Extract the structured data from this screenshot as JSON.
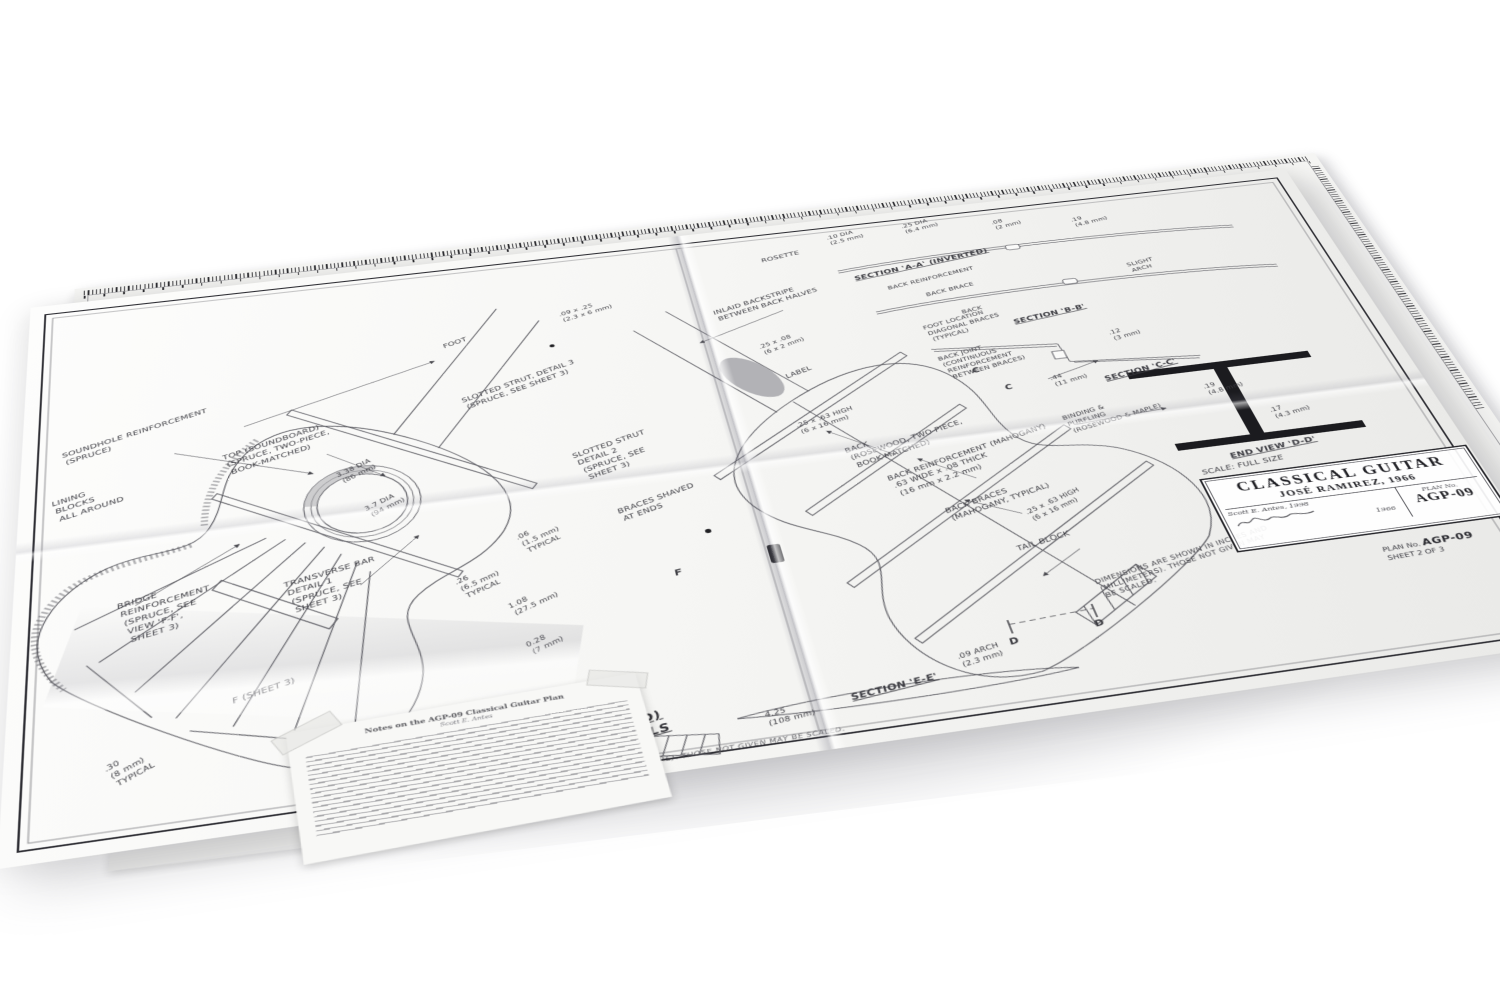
{
  "title_block": {
    "title": "CLASSICAL GUITAR",
    "subtitle": "JOSÉ RAMIREZ, 1966",
    "drawn_by": "Scott E. Antes, 1998",
    "plan_no_label": "PLAN No.",
    "plan_no": "AGP-09",
    "date": "1966"
  },
  "corner": {
    "plan_label": "PLAN No.",
    "plan_no": "AGP-09",
    "sheet": "SHEET 2 OF 3"
  },
  "undersheet": {
    "plan_label": "PLAN No.",
    "plan_no": "AGP-09",
    "sheet": "SHEET 3 OF 3"
  },
  "sections": {
    "aa": "SECTION 'A-A' (INVERTED)",
    "bb": "SECTION 'B-B'",
    "cc": "SECTION 'C-C'",
    "dd": "END VIEW 'D-D'",
    "ee": "SECTION 'E-E'",
    "scale": "SCALE: FULL SIZE",
    "left_caption": "TOP VIEW (INVERTED)\nWITH BRIDGE DETAILS"
  },
  "notes": {
    "dims_bottom": "DIMENSIONS ARE SHOWN IN INCHES AND (MILLIMETERS).  THOSE NOT GIVEN MAY BE SCALED.",
    "dims_right": "DIMENSIONS ARE SHOWN IN INCHES AND\n(MILLIMETERS).  THOSE NOT GIVEN MAY\nBE SCALED."
  },
  "note_paper": {
    "title": "Notes on the AGP-09 Classical Guitar Plan",
    "byline": "Scott E. Antes"
  },
  "annotations": {
    "soundhole_reinf": "SOUNDHOLE REINFORCEMENT\n(SPRUCE)",
    "foot": "FOOT",
    "top_soundboard": "TOP (SOUNDBOARD)\n(SPRUCE, TWO-PIECE,\nBOOK-MATCHED)",
    "lining_blocks": "LINING\nBLOCKS\nALL AROUND",
    "slotted_strut_3": "SLOTTED STRUT, DETAIL 3\n(SPRUCE, SEE SHEET 3)",
    "rosette_dia_1": "3.38 DIA\n(86 mm)",
    "rosette_dia_2": "3.7 DIA\n(94 mm)",
    "bridge_reinf": "BRIDGE\nREINFORCEMENT\n(SPRUCE, SEE\nVIEW 'F-F',\nSHEET 3)",
    "transverse_bar": "TRANSVERSE BAR\nDETAIL 1\n(SPRUCE, SEE\nSHEET 3)",
    "slotted_strut_2": "SLOTTED STRUT\nDETAIL 2\n(SPRUCE, SEE\nSHEET 3)",
    "braces_shaved": "BRACES SHAVED\nAT ENDS",
    "dim_06": ".06\n(1.5 mm)\nTYPICAL",
    "dim_26": ".26\n(6.5 mm)\nTYPICAL",
    "dim_108": "1.08\n(27.5 mm)",
    "dim_028": "0.28\n(7 mm)",
    "f_sheet_3": "F (SHEET 3)",
    "f_mark": "F",
    "dim_30": ".30\n(8 mm)\nTYPICAL",
    "dim_09x25": ".09 x .25\n(2.3 x 6 mm)",
    "inlaid_backstripe": "INLAID BACKSTRIPE\nBETWEEN BACK HALVES",
    "label": "LABEL",
    "dim_25x08": ".25 x .08\n(6 x 2 mm)",
    "dim_25x63_a": ".25 x .63 HIGH\n(6 x 16 mm)",
    "back": "BACK\n(ROSEWOOD, TWO-PIECE,\nBOOK-MATCHED)",
    "back_reinf": "BACK REINFORCEMENT (MAHOGANY)\n.63 WIDE x .08 THICK\n(16 mm x 2.2 mm)",
    "back_braces": "BACK BRACES\n(MAHOGANY, TYPICAL)",
    "dim_25x63_b": ".25 x .63 HIGH\n(6 x 16 mm)",
    "tail_block": "TAIL BLOCK",
    "dim_425": "4.25\n(108 mm)",
    "dim_arch": ".09 ARCH\n(2.3 mm)",
    "rosette": "ROSETTE",
    "dim_10dia": ".10 DIA\n(2.5 mm)",
    "dim_25dia": ".25 DIA\n(6.4 mm)",
    "dim_08a": ".08\n(2 mm)",
    "dim_19a": ".19\n(4.8 mm)",
    "back_reinf_small": "BACK REINFORCEMENT",
    "back_brace_small": "BACK BRACE",
    "back_small": "BACK",
    "slight_arch": "SLIGHT\nARCH",
    "foot_location": "FOOT LOCATION\nDIAGONAL BRACES\n(TYPICAL)",
    "back_joint": "BACK JOINT\n(CONTINUOUS\nREINFORCEMENT\nBETWEEN BRACES)",
    "dim_44": ".44\n(11 mm)",
    "dim_12b": ".12\n(3 mm)",
    "binding": "BINDING &\nPURFLING\n(ROSEWOOD & MAPLE)",
    "dim_19b": ".19\n(4.8 mm)",
    "dim_17": ".17\n(4.3 mm)",
    "c1": "C",
    "c2": "C",
    "d1": "D",
    "d2": "D"
  }
}
